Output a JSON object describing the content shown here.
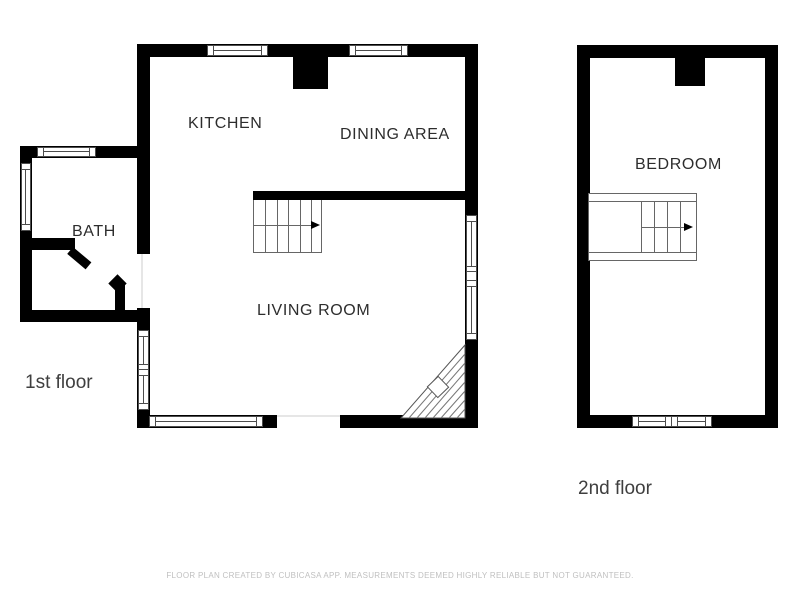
{
  "canvas": {
    "width": 800,
    "height": 600,
    "background": "#ffffff"
  },
  "floor1": {
    "label": "1st floor",
    "rooms": {
      "kitchen": "KITCHEN",
      "dining": "DINING AREA",
      "bath": "BATH",
      "living": "LIVING ROOM"
    }
  },
  "floor2": {
    "label": "2nd floor",
    "rooms": {
      "bedroom": "BEDROOM"
    }
  },
  "icons": {
    "stairs_direction": "right-arrow",
    "fireplace": "corner-hatched-triangle-with-diamond"
  },
  "footer": {
    "disclaimer": "FLOOR PLAN CREATED BY CUBICASA APP. MEASUREMENTS DEEMED HIGHLY RELIABLE BUT NOT GUARANTEED."
  },
  "colors": {
    "wall": "#000000",
    "window_outline": "#4d4d4d",
    "stairs_outline": "#666666",
    "room_label": "#2d2d2d",
    "floor_label": "#3f3f3f",
    "footer_text": "#c0c0c0",
    "background": "#ffffff"
  }
}
